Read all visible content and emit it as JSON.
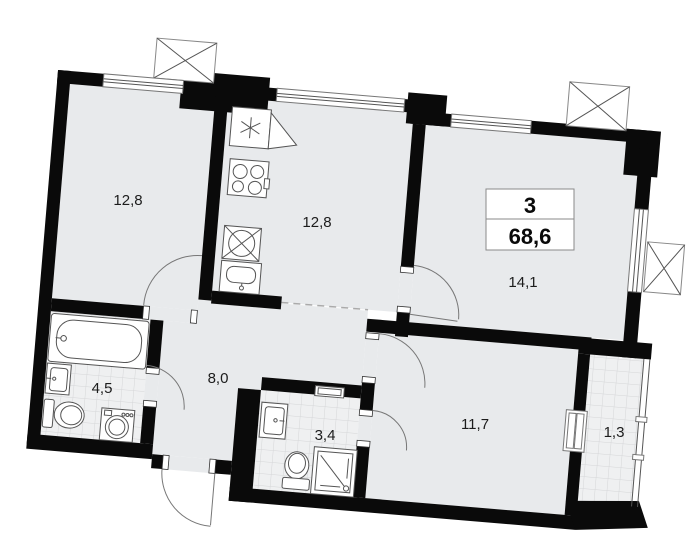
{
  "plan": {
    "title": "apartment-floor-plan",
    "summary": {
      "rooms_count": "3",
      "total_area": "68,6"
    },
    "rooms": [
      {
        "id": "living-room",
        "area": "12,8"
      },
      {
        "id": "kitchen-living",
        "area": "12,8"
      },
      {
        "id": "bedroom-large",
        "area": "14,1"
      },
      {
        "id": "bathroom",
        "area": "4,5"
      },
      {
        "id": "hallway",
        "area": "8,0"
      },
      {
        "id": "shower-room",
        "area": "3,4"
      },
      {
        "id": "bedroom",
        "area": "11,7"
      },
      {
        "id": "balcony",
        "area": "1,3"
      }
    ],
    "fixtures": [
      "bathtub",
      "washbasin",
      "toilet",
      "washing-machine",
      "fridge",
      "stove",
      "kitchen-sink",
      "base-cabinet-sink",
      "shower-cabin",
      "vent-shaft",
      "radiator"
    ],
    "colors": {
      "wall": "#0a0a0a",
      "room_fill": "#e8eaec",
      "tile_fill": "#eff0f1",
      "tile_line": "#d5d6d8",
      "fixture_line": "#555555",
      "label": "#1c1c1c",
      "summary_border": "#8a8a8a"
    }
  }
}
